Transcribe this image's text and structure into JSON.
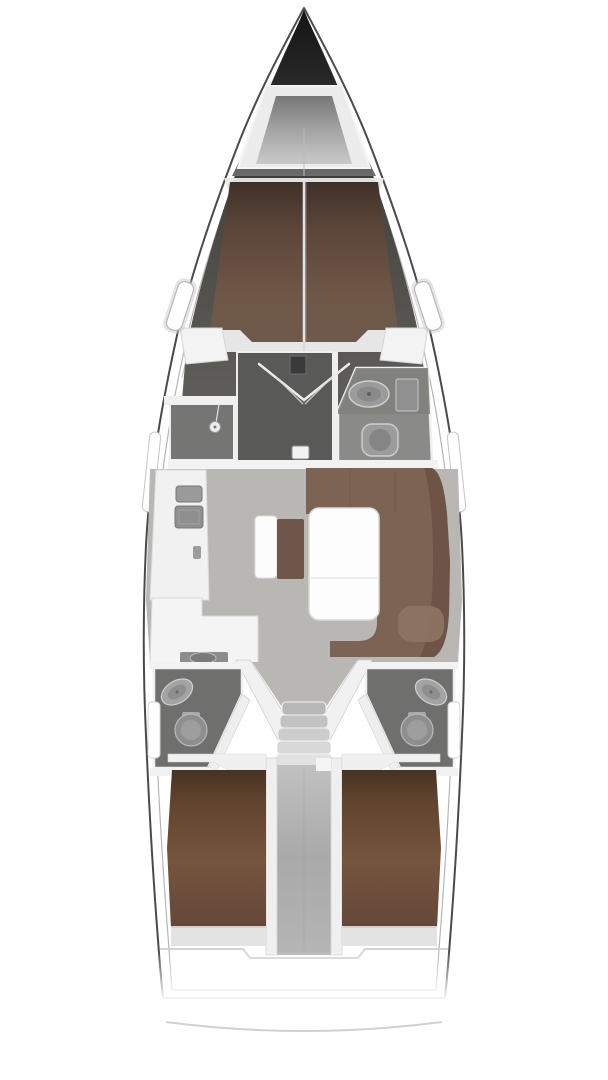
{
  "diagram": {
    "type": "yacht-interior-deck-plan",
    "orientation": "bow-up",
    "regions": [
      "anchor-locker",
      "forward-cabin-berth",
      "forward-shower",
      "forward-head",
      "saloon",
      "sideboard-stove",
      "galley",
      "saloon-bench",
      "saloon-stool",
      "dinette-table",
      "starboard-settee",
      "companionway-stairs",
      "aft-head-port",
      "aft-head-starboard",
      "engine-corridor",
      "aft-cabin-port-berth",
      "aft-cabin-starboard-berth"
    ]
  },
  "colors": {
    "background": "#ffffff",
    "hull_line": "#4a4a4a",
    "deck_line": "#b5b5b5",
    "bow_dark": "#1f1f1f",
    "locker_wall": "#ececec",
    "bulkhead_white": "#e9e9e9",
    "salon_floor": "#b9b7b4",
    "head_dark": "#595957",
    "shower_gray": "#757573",
    "head_mid": "#8a8a88",
    "head_aft": "#6f6f6d",
    "counter_white": "#f4f4f4",
    "sideboard_white": "#f1f1f1",
    "table_white": "#fdfdfd",
    "settee_brown": "#7d6354",
    "settee_light": "#8d7363",
    "stool_brown": "#6e564a",
    "fwd_berth_brown": "#64503f",
    "aft_berth_brown": "#6f4f3a",
    "fixture_gray": "#9e9e9e",
    "trim_white": "#f0f0f0",
    "transom_arc": "#c9c9c9"
  }
}
